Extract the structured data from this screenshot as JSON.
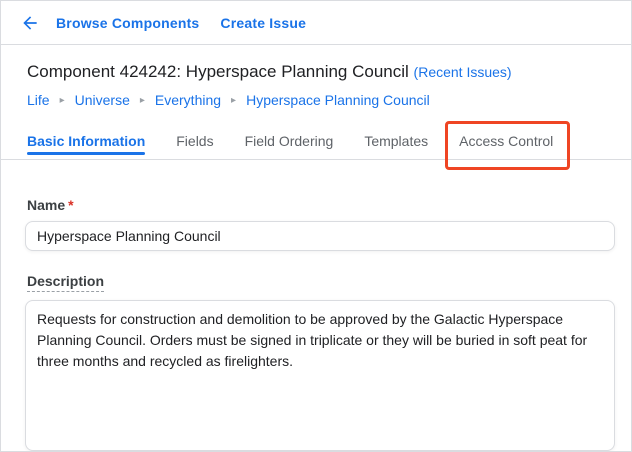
{
  "topbar": {
    "links": {
      "browse_components": "Browse Components",
      "create_issue": "Create Issue"
    }
  },
  "header": {
    "title": "Component 424242: Hyperspace Planning Council",
    "recent_issues": "(Recent Issues)"
  },
  "breadcrumb": {
    "separator": "▸",
    "items": [
      "Life",
      "Universe",
      "Everything",
      "Hyperspace Planning Council"
    ]
  },
  "tabs": [
    {
      "label": "Basic Information",
      "active": true
    },
    {
      "label": "Fields",
      "active": false
    },
    {
      "label": "Field Ordering",
      "active": false
    },
    {
      "label": "Templates",
      "active": false
    },
    {
      "label": "Access Control",
      "active": false,
      "annotated": true
    }
  ],
  "form": {
    "name": {
      "label": "Name",
      "required_marker": "*",
      "value": "Hyperspace Planning Council"
    },
    "description": {
      "label": "Description",
      "value": "Requests for construction and demolition to be approved by the Galactic Hyperspace Planning Council. Orders must be signed in triplicate or they will be buried in soft peat for three months and recycled as firelighters."
    }
  },
  "icons": {
    "back": "arrow-back-icon",
    "breadcrumb_separator": "chevron-right-icon"
  },
  "colors": {
    "link_blue": "#1a73e8",
    "annotation_orange_red": "#ef4523",
    "required_red": "#d93025",
    "text_primary": "#202124",
    "text_secondary": "#5f6368",
    "label_gray": "#3c4043",
    "border_gray": "#dadce0"
  }
}
